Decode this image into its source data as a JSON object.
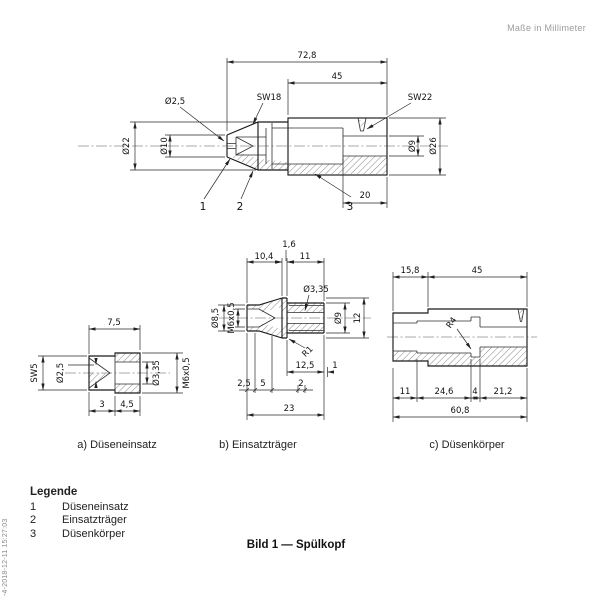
{
  "page": {
    "units_note": "Maße in Millimeter",
    "figure_caption": "Bild 1 — Spülkopf",
    "watermark": "-4-2018-12-11 15:27:03"
  },
  "legend": {
    "title": "Legende",
    "items": [
      {
        "num": "1",
        "label": "Düseneinsatz"
      },
      {
        "num": "2",
        "label": "Einsatzträger"
      },
      {
        "num": "3",
        "label": "Düsenkörper"
      }
    ]
  },
  "assembly": {
    "dim_total_length": "72,8",
    "dim_body_length": "45",
    "label_sw18": "SW18",
    "label_sw22": "SW22",
    "dim_tip_hole": "Ø2,5",
    "dim_cap_od": "Ø22",
    "dim_tip_od": "Ø10",
    "dim_bore": "Ø9",
    "dim_body_od": "Ø26",
    "dim_counterbore_len": "20",
    "callout_1": "1",
    "callout_2": "2",
    "callout_3": "3"
  },
  "part_a": {
    "caption": "a) Düseneinsatz",
    "dim_length": "7,5",
    "label_sw5": "SW5",
    "dim_hole": "Ø2,5",
    "dim_bore": "Ø3,35",
    "dim_thread": "M6x0,5",
    "dim_len_3": "3",
    "dim_len_4_5": "4,5"
  },
  "part_b": {
    "caption": "b) Einsatzträger",
    "dim_1_6": "1,6",
    "dim_10_4": "10,4",
    "dim_11": "11",
    "dim_d8_5": "Ø8,5",
    "dim_thread": "M6x0,5",
    "dim_d3_35": "Ø3,35",
    "dim_d9": "Ø9",
    "dim_12": "12",
    "label_r1": "R1",
    "dim_12_5": "12,5",
    "dim_1": "1",
    "dim_2_5": "2,5",
    "dim_5": "5",
    "dim_2": "2",
    "dim_23": "23"
  },
  "part_c": {
    "caption": "c) Düsenkörper",
    "dim_15_8": "15,8",
    "dim_45": "45",
    "label_r4": "R4",
    "dim_11": "11",
    "dim_24_6": "24,6",
    "dim_4": "4",
    "dim_21_2": "21,2",
    "dim_60_8": "60,8"
  }
}
